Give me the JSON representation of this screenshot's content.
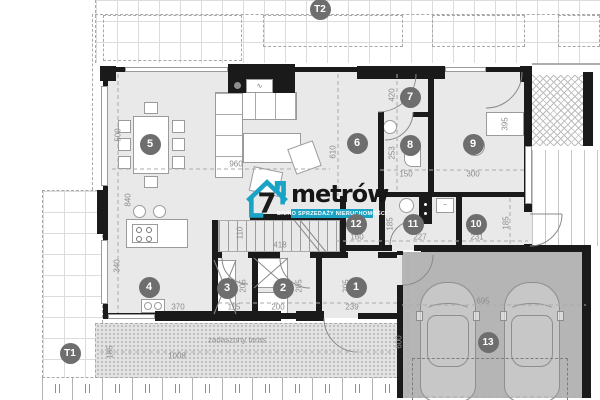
{
  "logo": {
    "brand_number": "7",
    "brand_name": "metrów",
    "tagline": "BIURO SPRZEDAŻY NIERUCHOMOŚCI",
    "accent_color": "#1aa3c4"
  },
  "labels": {
    "terrace": "zadaszony taras"
  },
  "room_markers": [
    {
      "id": "1",
      "x": 356,
      "y": 287
    },
    {
      "id": "2",
      "x": 283,
      "y": 288
    },
    {
      "id": "3",
      "x": 227,
      "y": 288
    },
    {
      "id": "4",
      "x": 149,
      "y": 287
    },
    {
      "id": "5",
      "x": 150,
      "y": 144
    },
    {
      "id": "6",
      "x": 357,
      "y": 143
    },
    {
      "id": "7",
      "x": 410,
      "y": 97
    },
    {
      "id": "8",
      "x": 410,
      "y": 145
    },
    {
      "id": "9",
      "x": 473,
      "y": 144
    },
    {
      "id": "10",
      "x": 476,
      "y": 224
    },
    {
      "id": "11",
      "x": 413,
      "y": 224
    },
    {
      "id": "12",
      "x": 356,
      "y": 224
    },
    {
      "id": "13",
      "x": 488,
      "y": 342
    },
    {
      "id": "T1",
      "x": 70,
      "y": 353
    },
    {
      "id": "T2",
      "x": 320,
      "y": 9
    }
  ],
  "dimensions": [
    {
      "text": "500",
      "x": 118,
      "y": 135,
      "v": 1
    },
    {
      "text": "960",
      "x": 236,
      "y": 164,
      "v": 0
    },
    {
      "text": "840",
      "x": 128,
      "y": 200,
      "v": 1
    },
    {
      "text": "340",
      "x": 117,
      "y": 266,
      "v": 1
    },
    {
      "text": "370",
      "x": 178,
      "y": 307,
      "v": 0
    },
    {
      "text": "610",
      "x": 333,
      "y": 152,
      "v": 1
    },
    {
      "text": "420",
      "x": 392,
      "y": 95,
      "v": 1
    },
    {
      "text": "253",
      "x": 392,
      "y": 153,
      "v": 1
    },
    {
      "text": "150",
      "x": 406,
      "y": 174,
      "v": 0
    },
    {
      "text": "300",
      "x": 473,
      "y": 174,
      "v": 0
    },
    {
      "text": "395",
      "x": 505,
      "y": 124,
      "v": 1
    },
    {
      "text": "110",
      "x": 240,
      "y": 233,
      "v": 1
    },
    {
      "text": "418",
      "x": 280,
      "y": 245,
      "v": 0
    },
    {
      "text": "160",
      "x": 357,
      "y": 237,
      "v": 0
    },
    {
      "text": "227",
      "x": 420,
      "y": 237,
      "v": 0
    },
    {
      "text": "231",
      "x": 477,
      "y": 237,
      "v": 0
    },
    {
      "text": "185",
      "x": 390,
      "y": 224,
      "v": 1
    },
    {
      "text": "185",
      "x": 506,
      "y": 223,
      "v": 1
    },
    {
      "text": "205",
      "x": 243,
      "y": 286,
      "v": 1
    },
    {
      "text": "205",
      "x": 299,
      "y": 286,
      "v": 1
    },
    {
      "text": "205",
      "x": 346,
      "y": 286,
      "v": 1
    },
    {
      "text": "115",
      "x": 234,
      "y": 307,
      "v": 0
    },
    {
      "text": "200",
      "x": 278,
      "y": 307,
      "v": 0
    },
    {
      "text": "239",
      "x": 352,
      "y": 307,
      "v": 0
    },
    {
      "text": "1008",
      "x": 177,
      "y": 356,
      "v": 0
    },
    {
      "text": "185",
      "x": 110,
      "y": 352,
      "v": 1
    },
    {
      "text": "695",
      "x": 483,
      "y": 301,
      "v": 0
    },
    {
      "text": "600",
      "x": 399,
      "y": 342,
      "v": 1
    }
  ],
  "colors": {
    "accent": "#1aa3c4",
    "floor": "#e9e9e9",
    "garage": "#b5b5b5",
    "wall": "#1a1a1a",
    "marker_bg": "#6e6e6e",
    "dim_text": "#8d8d8d"
  }
}
